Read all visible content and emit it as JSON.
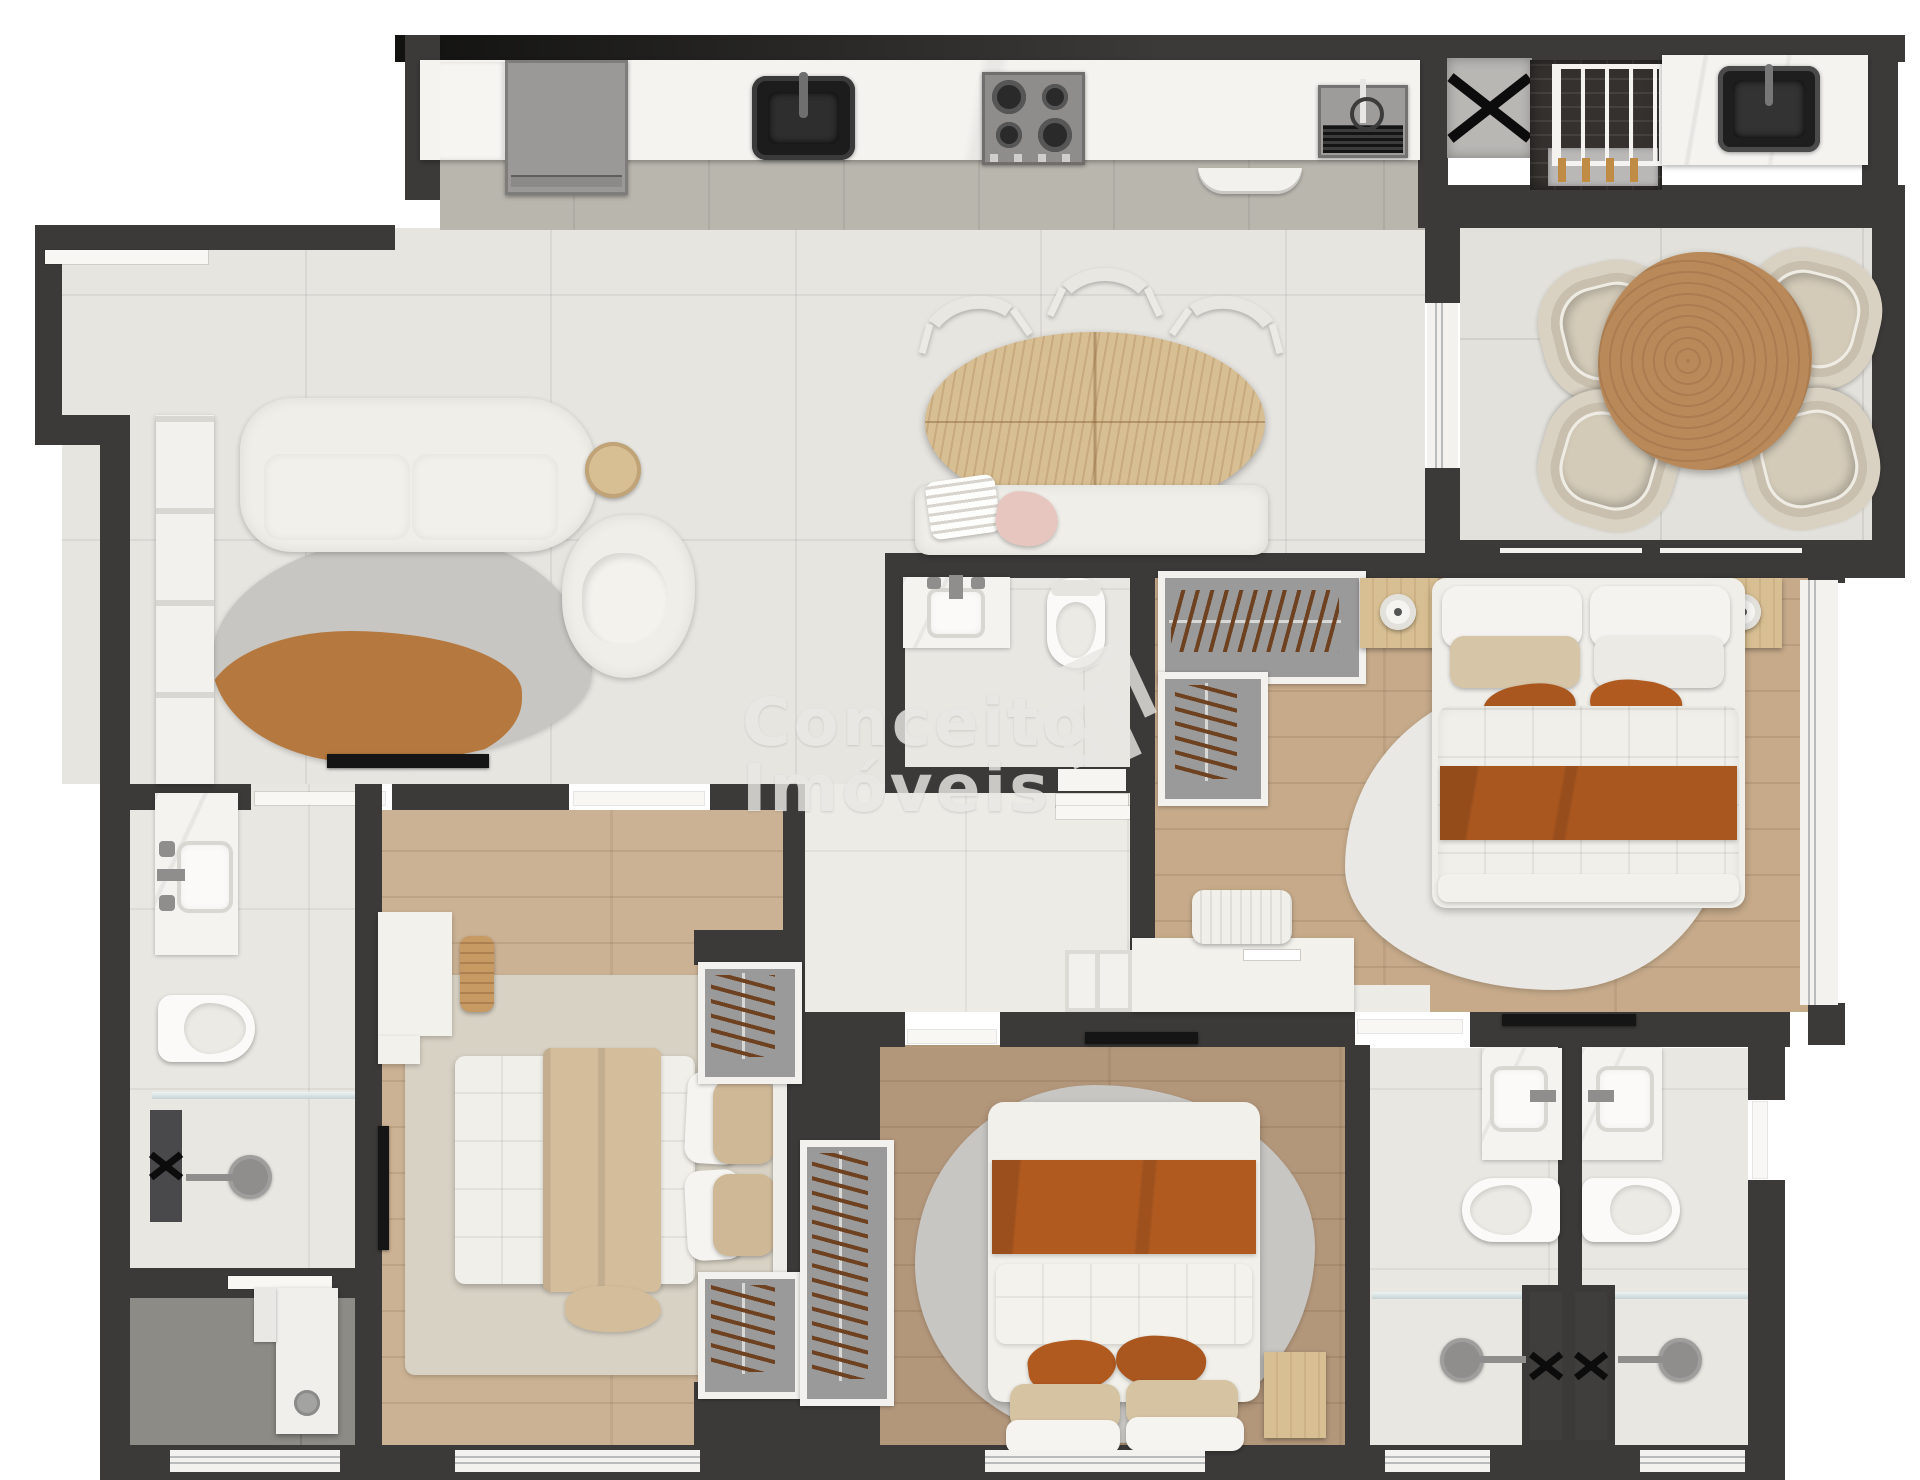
{
  "watermark": {
    "line1": "Conceito",
    "line2": "Imóveis",
    "logo": "nested-chevron-diamond-logo"
  },
  "palette": {
    "wall": "#3c3a38",
    "wallDark": "#121210",
    "tile": "#e7e5e0",
    "balconyTile": "#e3e1db",
    "aisle": "#b9b6ae",
    "hall": "#edebe6",
    "bath": "#e9e7e2",
    "serviceFloor": "#8d8b85",
    "woodA": "#ccb294",
    "woodB": "#b3977b",
    "woodC": "#c6aa8a",
    "marble": "#f4f3f0",
    "fabric": "#f0eee9",
    "rust": "#a9571f",
    "rustDeep": "#b05a20",
    "beige": "#d7c5a8",
    "rugGray": "#c8c6c2",
    "rugOrange": "#b5793f",
    "rugBeige": "#d8d2c5",
    "rugLight": "#eae8e4",
    "closetGray": "#9b9a9b",
    "frameWhite": "#f2f1ee",
    "steel": "#8f8e8c",
    "dark": "#151515",
    "woodFurn": "#d8bf93",
    "woodTable": "#b9895a",
    "glass": "#c3d2d3",
    "watermark": "#e9e8e4",
    "brick": "#34312e",
    "shaftGray": "#b9b7b4"
  },
  "rooms": [
    {
      "name": "kitchen",
      "furniture": [
        "refrigerator",
        "counter",
        "sink",
        "cooktop-4-burner",
        "prep-sink-drainboard",
        "wall-shelf"
      ]
    },
    {
      "name": "service-area",
      "furniture": [
        "drying-rack",
        "laundry-sink",
        "utility-shaft"
      ]
    },
    {
      "name": "living-room",
      "furniture": [
        "sofa",
        "accent-chair",
        "side-table",
        "area-rug",
        "tv",
        "bookshelf"
      ]
    },
    {
      "name": "dining-area",
      "furniture": [
        "oval-wood-table",
        "chair",
        "chair",
        "chair",
        "bench-with-pillows"
      ]
    },
    {
      "name": "balcony",
      "furniture": [
        "round-wood-table",
        "wicker-chair",
        "wicker-chair",
        "wicker-chair",
        "wicker-chair"
      ]
    },
    {
      "name": "powder-bathroom",
      "furniture": [
        "vanity-sink",
        "toilet"
      ]
    },
    {
      "name": "master-suite",
      "furniture": [
        "double-bed",
        "nightstand",
        "nightstand",
        "lamp",
        "lamp",
        "closet-hangers",
        "desk",
        "chair",
        "tv",
        "rug",
        "window"
      ]
    },
    {
      "name": "bedroom-2",
      "furniture": [
        "double-bed",
        "desk",
        "stool",
        "tv",
        "rug",
        "closet-hangers",
        "closet-hangers",
        "window"
      ]
    },
    {
      "name": "bedroom-3",
      "furniture": [
        "double-bed",
        "nightstand",
        "tv",
        "rug",
        "closet-hangers",
        "window"
      ]
    },
    {
      "name": "bathroom-2",
      "furniture": [
        "vanity-sink",
        "toilet",
        "shower",
        "glass-partition",
        "utility-shaft"
      ]
    },
    {
      "name": "bathroom-3",
      "furniture": [
        "vanity-sink",
        "toilet",
        "shower",
        "glass-partition"
      ]
    },
    {
      "name": "suite-bathroom",
      "furniture": [
        "vanity-sink",
        "toilet",
        "shower",
        "glass-partition"
      ]
    },
    {
      "name": "utility-room",
      "furniture": [
        "appliance",
        "window"
      ]
    }
  ]
}
